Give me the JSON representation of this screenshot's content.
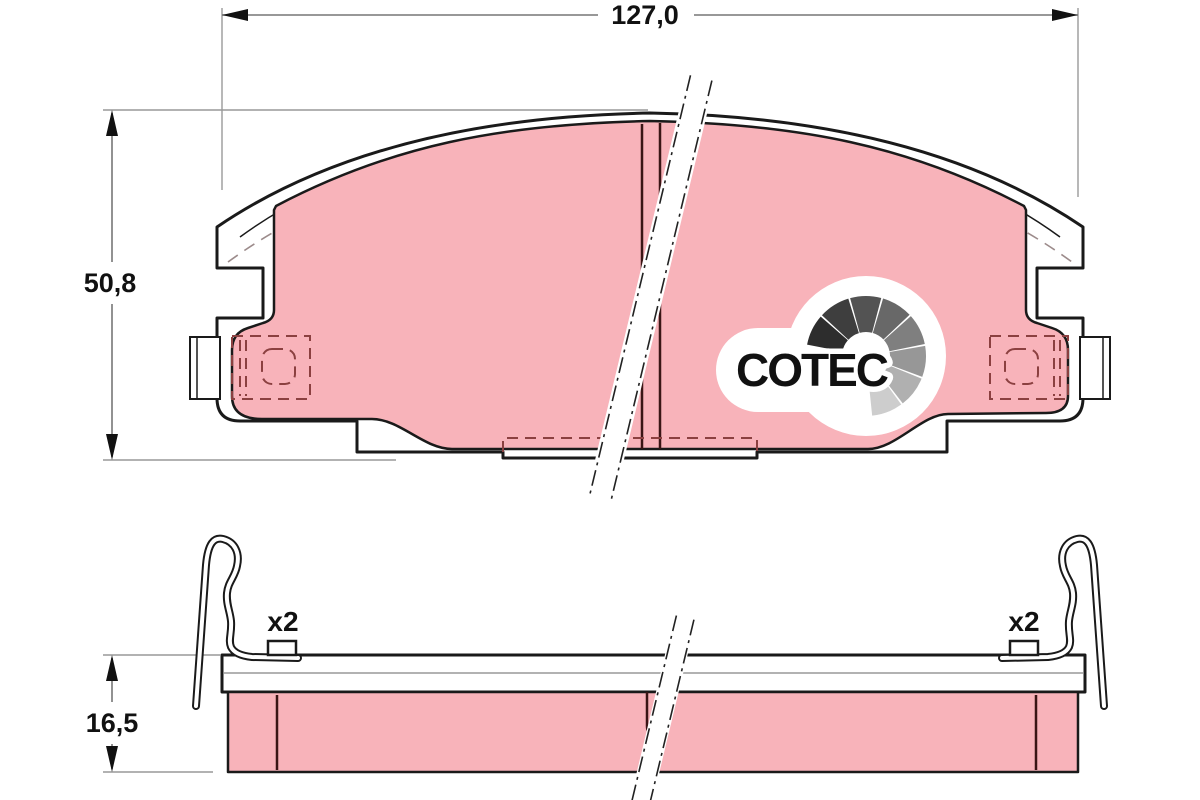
{
  "drawing": {
    "dimensions": {
      "width_label": "127,0",
      "height_label": "50,8",
      "thickness_label": "16,5"
    },
    "annotations": {
      "clip_count_left": "x2",
      "clip_count_right": "x2"
    }
  },
  "logo": {
    "text": "COTEC",
    "gauge_segments": [
      "#2d2d2d",
      "#3e3e3e",
      "#535353",
      "#686868",
      "#7f7f7f",
      "#979797",
      "#b0b0b0",
      "#cdcdcd"
    ]
  },
  "colors": {
    "pad_pink": "#f8b3ba",
    "outline": "#1a1a1a",
    "hidden_red": "#8b4040",
    "hidden_gray": "#9c8b8b",
    "slot_dark": "#3a1515",
    "dim_gray": "#777777",
    "ext_gray": "#999999",
    "logo_black": "#111111"
  }
}
